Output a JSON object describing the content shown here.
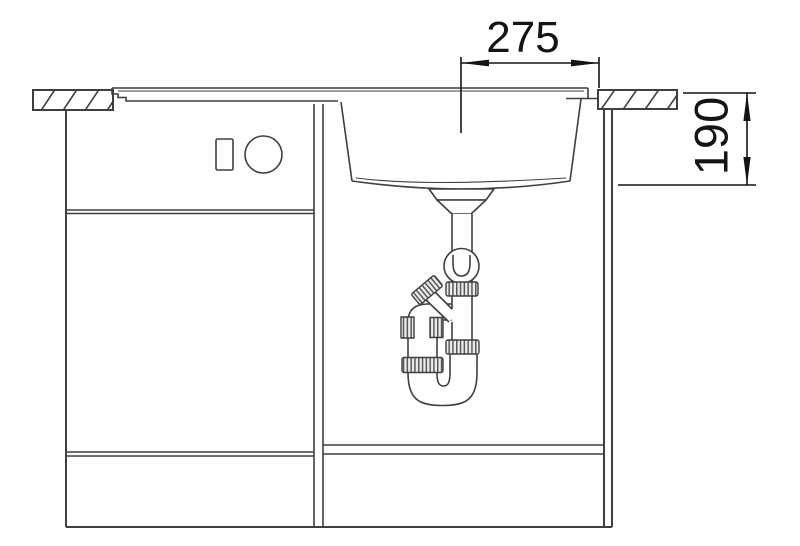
{
  "colors": {
    "background": "#ffffff",
    "line": "#3f3f3f",
    "dimension": "#141414",
    "fill": "#ffffff",
    "rib_fill": "#ececec",
    "rib_line": "#585858"
  },
  "dimensions": {
    "width": {
      "value": "275"
    },
    "depth": {
      "value": "190"
    }
  }
}
